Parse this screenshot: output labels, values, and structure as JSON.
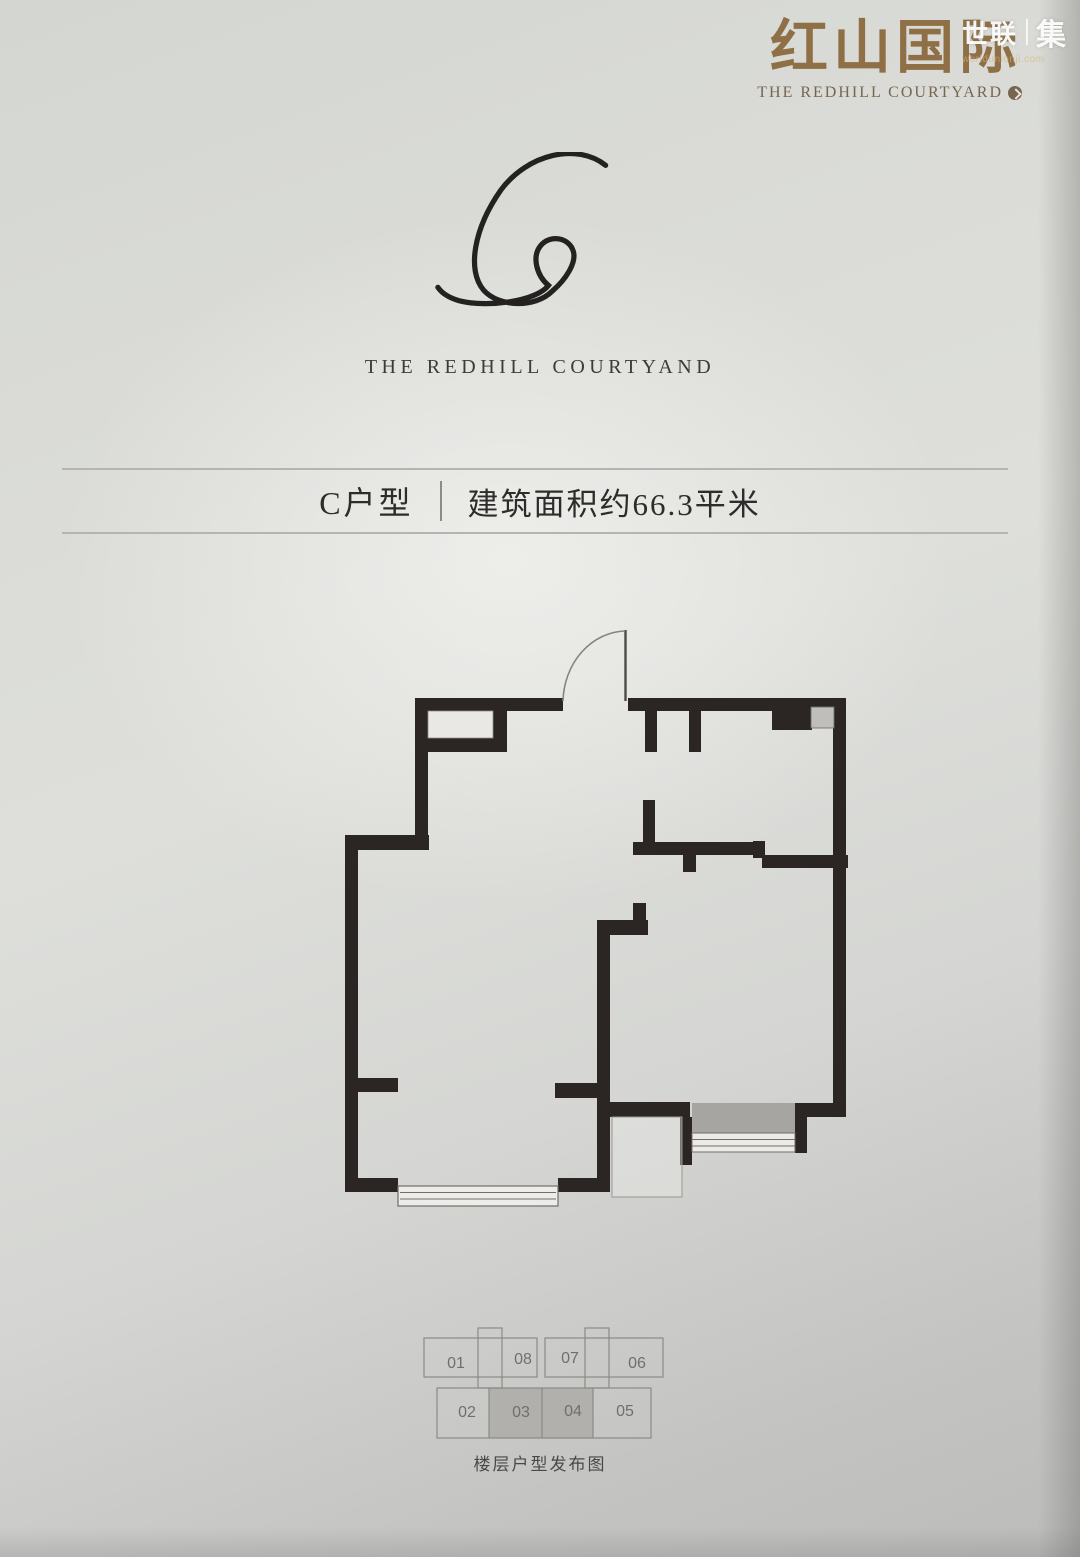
{
  "brand": {
    "logo_text": "红山国际",
    "logo_subtitle": "The Redhill Courtyard",
    "logo_color": "#8f7046",
    "badge_icon": "circle-arrow"
  },
  "watermark": {
    "left": "世联",
    "right": "集",
    "url": "worldunionji.com"
  },
  "monogram": {
    "letter": "C",
    "path": "M 182 14 C 152 -10 100 2 72 40 C 44 80 36 124 54 145 C 70 163 108 164 126 146 C 140 134 152 116 148 104 C 144 90 124 86 114 98 C 104 110 110 130 122 140 C 110 156 60 164 28 156 C 18 153 10 148 6 142",
    "stroke": "#232220",
    "wordmark": "THE REDHILL COURTYAND"
  },
  "title_band": {
    "unit_label": "C户型",
    "area_label": "建筑面积约66.3平米",
    "line_color": "#b5b4b0"
  },
  "floor_plan": {
    "wall_color": "#2b2523",
    "walls": [
      [
        415,
        698,
        148,
        13
      ],
      [
        628,
        698,
        217,
        13
      ],
      [
        415,
        711,
        13,
        139
      ],
      [
        415,
        738,
        92,
        14
      ],
      [
        493,
        711,
        14,
        34
      ],
      [
        345,
        835,
        84,
        15
      ],
      [
        345,
        850,
        13,
        342
      ],
      [
        358,
        1078,
        40,
        14
      ],
      [
        345,
        1178,
        53,
        14
      ],
      [
        558,
        1178,
        52,
        14
      ],
      [
        597,
        920,
        13,
        272
      ],
      [
        597,
        920,
        51,
        15
      ],
      [
        633,
        903,
        13,
        32
      ],
      [
        555,
        1083,
        42,
        15
      ],
      [
        645,
        711,
        12,
        41
      ],
      [
        689,
        711,
        12,
        41
      ],
      [
        633,
        842,
        130,
        13
      ],
      [
        643,
        800,
        12,
        42
      ],
      [
        683,
        855,
        13,
        17
      ],
      [
        753,
        841,
        12,
        17
      ],
      [
        762,
        855,
        86,
        13
      ],
      [
        833,
        698,
        13,
        419
      ],
      [
        772,
        711,
        40,
        19
      ],
      [
        795,
        1103,
        50,
        14
      ],
      [
        597,
        1102,
        93,
        15
      ],
      [
        680,
        1117,
        12,
        48
      ],
      [
        795,
        1103,
        12,
        50
      ]
    ],
    "boxes": [
      {
        "x": 428,
        "y": 711,
        "w": 65,
        "h": 27,
        "fill": "#e9e8e5",
        "stroke": "#8f8e8a",
        "sw": 0.8,
        "name": "closet-niche"
      },
      {
        "x": 811,
        "y": 707,
        "w": 23,
        "h": 21,
        "fill": "#c0bebb",
        "stroke": "#6f6e6a",
        "sw": 0.9,
        "name": "appliance-box"
      },
      {
        "x": 692,
        "y": 1103,
        "w": 103,
        "h": 30,
        "fill": "#a7a5a2",
        "sw": 0,
        "name": "balcony-deck"
      },
      {
        "x": 692,
        "y": 1133,
        "w": 103,
        "h": 19,
        "fill": "#ebeae7",
        "stroke": "#6f6e6a",
        "sw": 1,
        "name": "balcony-window"
      },
      {
        "x": 398,
        "y": 1186,
        "w": 160,
        "h": 20,
        "fill": "#edece9",
        "stroke": "#6f6e6a",
        "sw": 1.2,
        "name": "living-room-window"
      },
      {
        "x": 612,
        "y": 1117,
        "w": 70,
        "h": 80,
        "fill": "rgba(236,235,232,0.4)",
        "stroke": "#98968f",
        "sw": 1,
        "name": "utility-platform"
      }
    ],
    "lines": [
      {
        "x1": 400,
        "y1": 1192.5,
        "x2": 556,
        "y2": 1192.5,
        "s": "#6f6e6a",
        "w": 1.1
      },
      {
        "x1": 400,
        "y1": 1199,
        "x2": 556,
        "y2": 1199,
        "s": "#6f6e6a",
        "w": 1.1
      },
      {
        "x1": 692,
        "y1": 1139.5,
        "x2": 795,
        "y2": 1139.5,
        "s": "#6f6e6a",
        "w": 1
      },
      {
        "x1": 692,
        "y1": 1146,
        "x2": 795,
        "y2": 1146,
        "s": "#6f6e6a",
        "w": 1
      },
      {
        "x1": 625.5,
        "y1": 630,
        "x2": 625.5,
        "y2": 701,
        "s": "#4c4b48",
        "w": 2.4
      }
    ],
    "paths": [
      {
        "d": "M 563 701 A 64 72 0 0 1 625 631",
        "s": "#86847f",
        "w": 1.6
      }
    ]
  },
  "key_plan": {
    "stroke_color": "#8a8a86",
    "label_color": "#6f6f6c",
    "highlight_color": "#b2b0ad",
    "outline_rects": [
      [
        424,
        1338,
        113,
        39
      ],
      [
        545,
        1338,
        118,
        39
      ],
      [
        478,
        1328,
        24,
        60
      ],
      [
        585,
        1328,
        24,
        60
      ],
      [
        437,
        1388,
        214,
        50
      ]
    ],
    "highlight": {
      "x": 489,
      "y": 1388,
      "w": 104,
      "h": 50
    },
    "divider_lines": [
      [
        489,
        1388,
        489,
        1438
      ],
      [
        542,
        1388,
        542,
        1438
      ],
      [
        593,
        1388,
        593,
        1438
      ]
    ],
    "labels": [
      {
        "t": "01",
        "x": 456,
        "y": 1368
      },
      {
        "t": "08",
        "x": 523,
        "y": 1364
      },
      {
        "t": "07",
        "x": 570,
        "y": 1363
      },
      {
        "t": "06",
        "x": 637,
        "y": 1368
      },
      {
        "t": "02",
        "x": 467,
        "y": 1417
      },
      {
        "t": "03",
        "x": 521,
        "y": 1417
      },
      {
        "t": "04",
        "x": 573,
        "y": 1416
      },
      {
        "t": "05",
        "x": 625,
        "y": 1416
      }
    ],
    "highlighted_units": [
      "03",
      "04"
    ],
    "caption": "楼层户型发布图"
  }
}
